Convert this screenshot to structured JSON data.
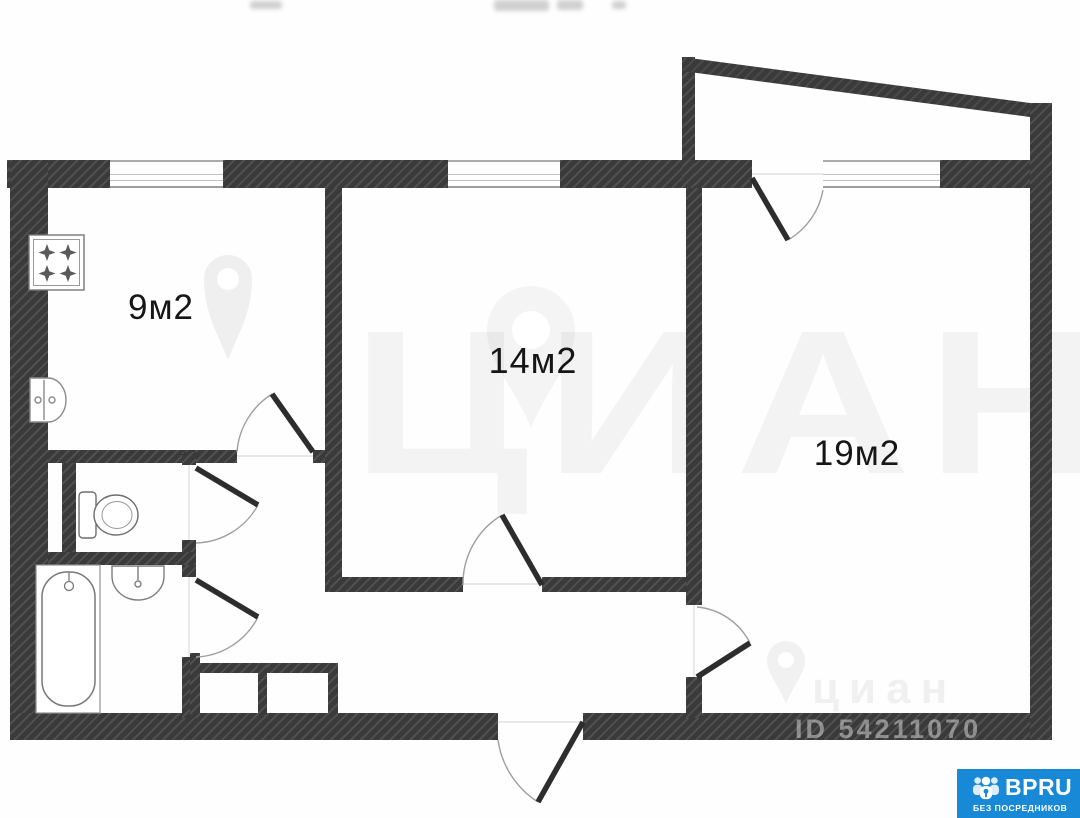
{
  "plan": {
    "title": "2-room apartment floor plan",
    "rooms": [
      {
        "id": "kitchen",
        "label": "9м2"
      },
      {
        "id": "room-14",
        "label": "14м2"
      },
      {
        "id": "room-19",
        "label": "19м2"
      }
    ],
    "fixtures": [
      {
        "icon": "stove-icon",
        "room": "kitchen"
      },
      {
        "icon": "sink-icon",
        "room": "kitchen"
      },
      {
        "icon": "toilet-icon",
        "room": "wc"
      },
      {
        "icon": "bathtub-icon",
        "room": "bathroom"
      },
      {
        "icon": "sink-icon",
        "room": "bathroom"
      }
    ],
    "colors": {
      "wall": "#3a3a3a",
      "background": "#fefefe",
      "badge_blue": "#1789d7"
    }
  },
  "watermark": {
    "brand_large": "ЦИАН",
    "brand_small": "циан",
    "listing_id": "ID 54211070"
  },
  "badge": {
    "title": "BPRU",
    "subtitle": "БЕЗ ПОСРЕДНИКОВ"
  }
}
